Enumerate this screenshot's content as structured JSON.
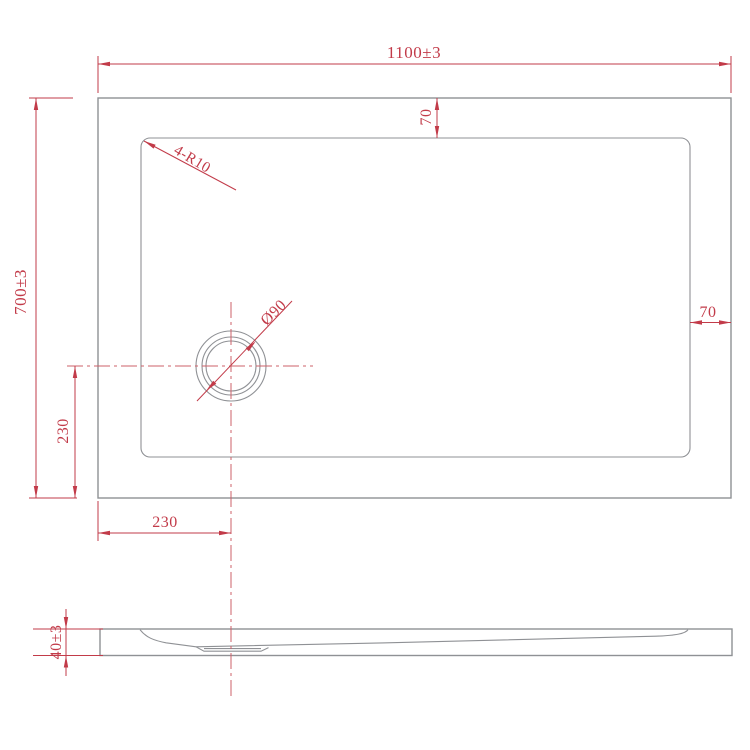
{
  "drawing": {
    "title": "Rectangular shower tray dimension drawing",
    "colors": {
      "dimension_red": "#c23b49",
      "centerline_red": "#cc6069",
      "geometry_gray": "#8f9195",
      "background": "#ffffff"
    },
    "views": {
      "plan": {
        "width_label": "1100±3",
        "height_label": "700±3",
        "top_rim_label": "70",
        "right_rim_label": "70",
        "corner_radius_label": "4-R10",
        "drain_diameter_label": "Ø90",
        "drain_from_left_label": "230",
        "drain_from_bottom_label": "230"
      },
      "section": {
        "thickness_label": "40±3"
      }
    }
  }
}
